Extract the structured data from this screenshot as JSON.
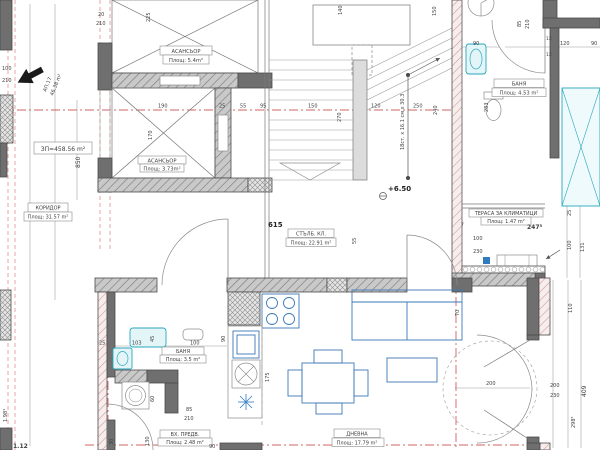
{
  "drawing": {
    "type": "architectural floor plan",
    "language": "bg"
  },
  "rooms": {
    "elevator1": {
      "name": "АСАНСЬОР",
      "area": "Площ: 5.4m²"
    },
    "elevator2": {
      "name": "АСАНСЬОР",
      "area": "Площ: 3.73m²"
    },
    "stair_cage": {
      "name": "СТЪЛБ. КЛ.",
      "area": "Площ: 22.91 m²"
    },
    "corridor": {
      "name": "КОРИДОР",
      "area": "Площ: 31.57 m²"
    },
    "bath_top": {
      "name": "БАНЯ",
      "area": "Площ: 4.53 m²"
    },
    "terrace_ac": {
      "name": "ТЕРАСА ЗА КЛИМАТИЦИ",
      "area": "Площ: 1.47 m²"
    },
    "bath_low": {
      "name": "БАНЯ",
      "area": "Площ: 3.5 m²"
    },
    "vestibule": {
      "name": "ВХ. ПРЕДВ.",
      "area": "Площ: 2.48 m²"
    },
    "living": {
      "name": "ДНЕВНА",
      "area": "Площ: 17.79 m²"
    }
  },
  "annotations": {
    "apartment_no": "АП.17",
    "apartment_area": "46.38 m²",
    "built_area": "ЗП=458.56 m²",
    "level": "+6.50",
    "stair_spec": "18ст. x 16.1 см x 30.3"
  },
  "dims": {
    "top20": "20",
    "top210": "210",
    "v225": "225",
    "left100": "100",
    "left210": "210",
    "v850": "850",
    "ax190": "190",
    "ax25": "25",
    "ax55": "55",
    "ax95": "95",
    "v170": "170",
    "st150": "150",
    "st120": "120",
    "st250": "250",
    "v270": "270",
    "v240": "240",
    "v140": "140",
    "v150t": "150",
    "tr85": "85",
    "tr210": "210",
    "v283": "283",
    "row90a": "90",
    "row120": "120",
    "row90b": "90",
    "t12a": "12",
    "t12b": "12",
    "ter2475": "247⁵",
    "ter100": "100",
    "ter230": "230",
    "ter25": "25",
    "terr100": "100",
    "ter131": "131",
    "ter7": "7",
    "c615": "615",
    "c55": "55",
    "b25": "25",
    "b103": "103",
    "b100": "100",
    "b45": "45",
    "b60": "60",
    "b85": "85",
    "b210": "210",
    "b130": "130",
    "b30": "30",
    "b90": "90",
    "k175": "175",
    "k90": "90",
    "r70": "70",
    "r200": "200",
    "rr200": "200",
    "rr230": "230",
    "r110": "110",
    "r409": "409",
    "r2985": "298⁵",
    "bl198": "1.98¹",
    "bl112": "1.12"
  },
  "colors": {
    "axis_red": "#c23434",
    "fixture_cyan": "#2aa7bd",
    "furniture_blue": "#3b79b5",
    "wall_gray": "#6f6f6f",
    "background": "#ffffff"
  }
}
